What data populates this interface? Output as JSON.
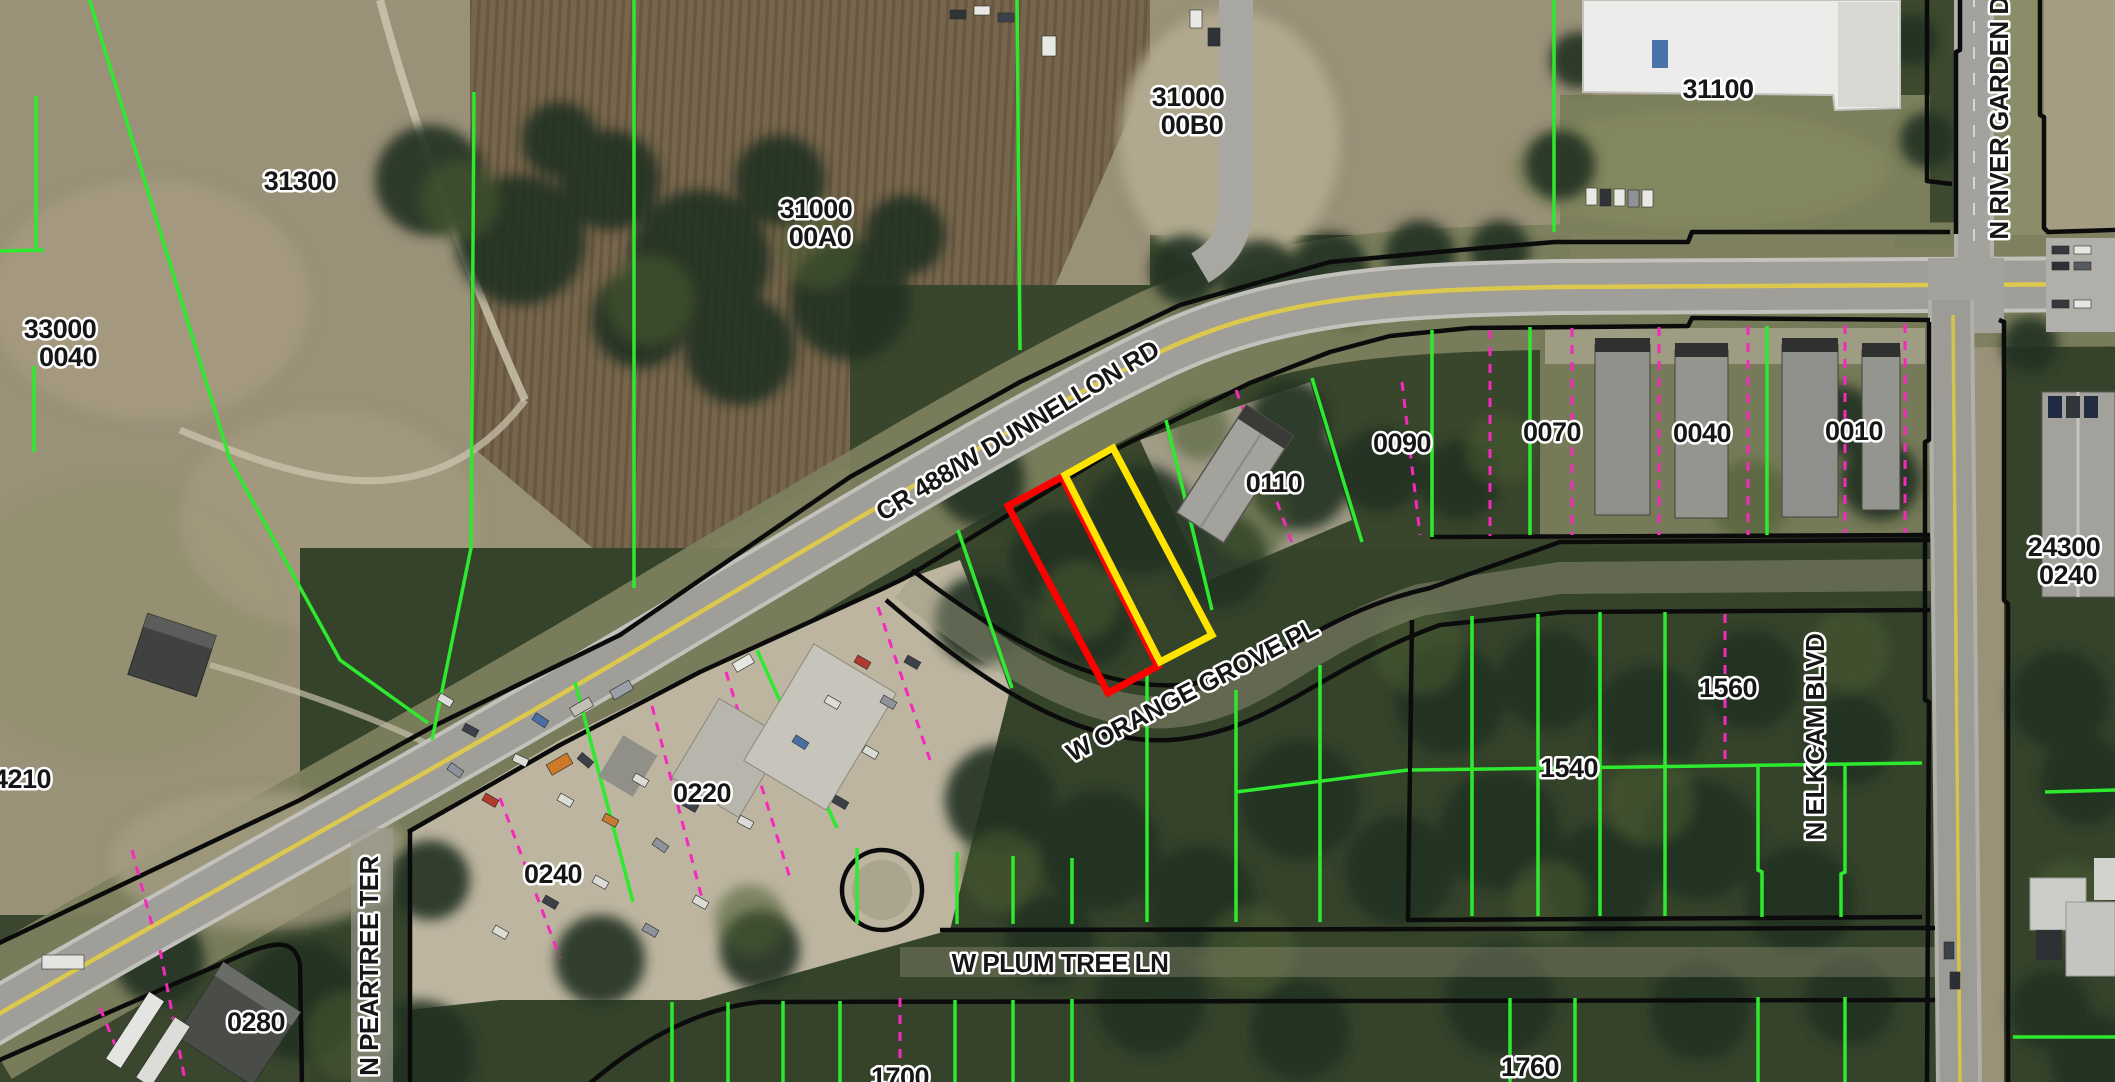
{
  "map": {
    "type": "gis-parcel-aerial-map",
    "highlight": {
      "selected_parcel_outline_red": "#ff0000",
      "selected_parcel_outline_yellow": "#ffe400"
    },
    "line_colors": {
      "parcel_line_green": "#2eea2e",
      "lot_line_magenta": "#f728bc",
      "boundary_black": "#0b0b0b"
    },
    "parcel_labels": {
      "p31300": "31300",
      "p33000_l1": "33000",
      "p33000_l2": "0040",
      "p31000a_l1": "31000",
      "p31000a_l2": "00A0",
      "p31000b_l1": "31000",
      "p31000b_l2": "00B0",
      "p31100": "31100",
      "p0110": "0110",
      "p0090": "0090",
      "p0070": "0070",
      "p0040": "0040",
      "p0010": "0010",
      "p24300_l1": "24300",
      "p24300_l2": "0240",
      "p1560": "1560",
      "p1540": "1540",
      "p1760": "1760",
      "p1700": "1700",
      "p0220": "0220",
      "p0240": "0240",
      "p0280": "0280",
      "p4210": "4210"
    },
    "road_labels": {
      "dunnellon": "CR 488/W DUNNELLON RD",
      "orange_grove": "W ORANGE GROVE PL",
      "plum_tree": "W PLUM TREE LN",
      "peartree": "N PEARTREE TER",
      "elkcam": "N ELKCAM BLVD",
      "river_garden": "N RIVER GARDEN D"
    }
  }
}
